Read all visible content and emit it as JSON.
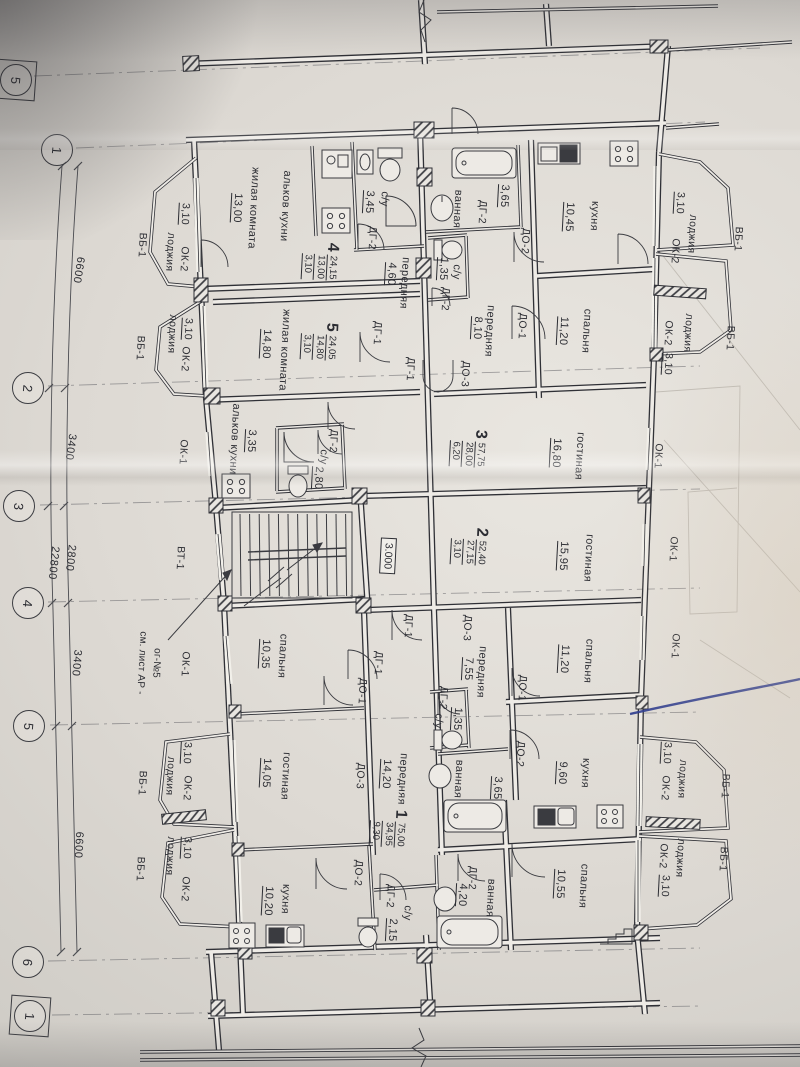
{
  "sheet": {
    "paper_color": "#dfdcd6",
    "ink_color": "#2c2d33",
    "pen_color": "#2c3b8e",
    "drawing_type": "apartment floor plan"
  },
  "axes": [
    {
      "label": "5",
      "x": 16,
      "y": 80,
      "boxed": true
    },
    {
      "label": "1",
      "x": 57,
      "y": 150,
      "boxed": false
    },
    {
      "label": "2",
      "x": 28,
      "y": 388,
      "boxed": false
    },
    {
      "label": "3",
      "x": 19,
      "y": 506,
      "boxed": false
    },
    {
      "label": "4",
      "x": 28,
      "y": 603,
      "boxed": false
    },
    {
      "label": "5",
      "x": 29,
      "y": 726,
      "boxed": false
    },
    {
      "label": "6",
      "x": 28,
      "y": 962,
      "boxed": false
    },
    {
      "label": "1",
      "x": 30,
      "y": 1016,
      "boxed": true
    }
  ],
  "dimensions": [
    {
      "text": "6600",
      "x": 78,
      "y": 270,
      "rot": 99
    },
    {
      "text": "3400",
      "x": 70,
      "y": 447,
      "rot": 98
    },
    {
      "text": "2800",
      "x": 70,
      "y": 558,
      "rot": 96
    },
    {
      "text": "22800",
      "x": 53,
      "y": 563,
      "rot": 96
    },
    {
      "text": "3400",
      "x": 76,
      "y": 663,
      "rot": 95
    },
    {
      "text": "6600",
      "x": 78,
      "y": 845,
      "rot": 93
    }
  ],
  "apartments": [
    {
      "number": "4",
      "total_area": "24,15",
      "living_area": "13,00",
      "kitchen_area": "3,10",
      "x": 320,
      "y": 261
    },
    {
      "number": "5",
      "total_area": "24,05",
      "living_area": "14,80",
      "kitchen_area": "3,10",
      "x": 319,
      "y": 341
    },
    {
      "number": "3",
      "total_area": "57,75",
      "living_area": "28,00",
      "kitchen_area": "6,20",
      "x": 468,
      "y": 448
    },
    {
      "number": "2",
      "total_area": "52,40",
      "living_area": "27,15",
      "kitchen_area": "3,10",
      "x": 469,
      "y": 546
    },
    {
      "number": "1",
      "total_area": "75,00",
      "living_area": "34,95",
      "kitchen_area": "9,30",
      "x": 388,
      "y": 828
    }
  ],
  "rooms": [
    {
      "n": "жилая комната",
      "a": "13,00",
      "nx": 253,
      "ny": 208,
      "ax": 237,
      "ay": 208
    },
    {
      "n": "альков кухни",
      "a": "",
      "nx": 285,
      "ny": 206,
      "ax": 0,
      "ay": 0
    },
    {
      "n": "с/у",
      "a": "3,45",
      "nx": 384,
      "ny": 199,
      "ax": 369,
      "ay": 202
    },
    {
      "n": "передняя",
      "a": "4,60",
      "nx": 404,
      "ny": 283,
      "ax": 391,
      "ay": 274
    },
    {
      "n": "ванная",
      "a": "3,65",
      "nx": 457,
      "ny": 209,
      "ax": 504,
      "ay": 196
    },
    {
      "n": "с/у",
      "a": "1,35",
      "nx": 456,
      "ny": 272,
      "ax": 443,
      "ay": 269
    },
    {
      "n": "кухня",
      "a": "10,45",
      "nx": 594,
      "ny": 216,
      "ax": 569,
      "ay": 217
    },
    {
      "n": "передняя",
      "a": "8,10",
      "nx": 489,
      "ny": 331,
      "ax": 477,
      "ay": 328
    },
    {
      "n": "спальня",
      "a": "11,20",
      "nx": 586,
      "ny": 331,
      "ax": 563,
      "ay": 331
    },
    {
      "n": "жилая комната",
      "a": "14,80",
      "nx": 284,
      "ny": 350,
      "ax": 266,
      "ay": 344
    },
    {
      "n": "альков кухни",
      "a": "3,35",
      "nx": 234,
      "ny": 439,
      "ax": 251,
      "ay": 441
    },
    {
      "n": "с/у",
      "a": "2,80",
      "nx": 323,
      "ny": 457,
      "ax": 318,
      "ay": 478
    },
    {
      "n": "гостиная",
      "a": "16,80",
      "nx": 579,
      "ny": 456,
      "ax": 556,
      "ay": 453
    },
    {
      "n": "гостиная",
      "a": "15,95",
      "nx": 588,
      "ny": 558,
      "ax": 563,
      "ay": 556
    },
    {
      "n": "спальня",
      "a": "10,35",
      "nx": 282,
      "ny": 656,
      "ax": 265,
      "ay": 654
    },
    {
      "n": "передняя",
      "a": "7,55",
      "nx": 481,
      "ny": 672,
      "ax": 468,
      "ay": 669
    },
    {
      "n": "спальня",
      "a": "11,20",
      "nx": 588,
      "ny": 661,
      "ax": 564,
      "ay": 659
    },
    {
      "n": "с/у",
      "a": "1,35",
      "nx": 438,
      "ny": 721,
      "ax": 457,
      "ay": 719
    },
    {
      "n": "кухня",
      "a": "9,60",
      "nx": 585,
      "ny": 773,
      "ax": 562,
      "ay": 773
    },
    {
      "n": "ванная",
      "a": "3,65",
      "nx": 458,
      "ny": 779,
      "ax": 497,
      "ay": 788
    },
    {
      "n": "передняя",
      "a": "14,20",
      "nx": 402,
      "ny": 779,
      "ax": 386,
      "ay": 774
    },
    {
      "n": "гостиная",
      "a": "14,05",
      "nx": 285,
      "ny": 776,
      "ax": 266,
      "ay": 773
    },
    {
      "n": "кухня",
      "a": "10,20",
      "nx": 285,
      "ny": 899,
      "ax": 268,
      "ay": 901
    },
    {
      "n": "спальня",
      "a": "10,55",
      "nx": 583,
      "ny": 886,
      "ax": 560,
      "ay": 884
    },
    {
      "n": "ванная",
      "a": "4,20",
      "nx": 490,
      "ny": 898,
      "ax": 462,
      "ay": 895
    },
    {
      "n": "с/у",
      "a": "2,15",
      "nx": 407,
      "ny": 913,
      "ax": 392,
      "ay": 930
    }
  ],
  "tags": [
    {
      "t": "ДГ-2",
      "x": 372,
      "y": 238
    },
    {
      "t": "ДГ-2",
      "x": 445,
      "y": 299
    },
    {
      "t": "ДГ-2",
      "x": 482,
      "y": 212
    },
    {
      "t": "ДГ-2",
      "x": 333,
      "y": 441
    },
    {
      "t": "ДГ-2",
      "x": 443,
      "y": 698
    },
    {
      "t": "ДГ-2",
      "x": 472,
      "y": 878
    },
    {
      "t": "ДГ-2",
      "x": 390,
      "y": 896
    },
    {
      "t": "ДО-2",
      "x": 525,
      "y": 241
    },
    {
      "t": "ДО-2",
      "x": 520,
      "y": 754
    },
    {
      "t": "ДО-2",
      "x": 358,
      "y": 873
    },
    {
      "t": "ДО-1",
      "x": 522,
      "y": 326
    },
    {
      "t": "ДО-1",
      "x": 362,
      "y": 691
    },
    {
      "t": "ДО-1",
      "x": 522,
      "y": 688
    },
    {
      "t": "ДГ-1",
      "x": 377,
      "y": 333
    },
    {
      "t": "ДГ-1",
      "x": 410,
      "y": 369
    },
    {
      "t": "ДГ-1",
      "x": 408,
      "y": 626
    },
    {
      "t": "ДГ-1",
      "x": 378,
      "y": 663
    },
    {
      "t": "ДО-3",
      "x": 465,
      "y": 374
    },
    {
      "t": "ДО-3",
      "x": 467,
      "y": 628
    },
    {
      "t": "ДО-3",
      "x": 360,
      "y": 776
    },
    {
      "t": "ВТ-1",
      "x": 180,
      "y": 558
    },
    {
      "t": "ОК-1",
      "x": 183,
      "y": 452
    },
    {
      "t": "ОК-1",
      "x": 185,
      "y": 664
    },
    {
      "t": "ОК-1",
      "x": 658,
      "y": 456
    },
    {
      "t": "ОК-1",
      "x": 673,
      "y": 549
    },
    {
      "t": "ОК-1",
      "x": 675,
      "y": 646
    },
    {
      "t": "3,10",
      "x": 185,
      "y": 214,
      "u": true
    },
    {
      "t": "лоджия",
      "x": 170,
      "y": 252
    },
    {
      "t": "ОК-2",
      "x": 184,
      "y": 259
    },
    {
      "t": "ВБ-1",
      "x": 142,
      "y": 245
    },
    {
      "t": "3,10",
      "x": 188,
      "y": 329,
      "u": true
    },
    {
      "t": "лоджия",
      "x": 172,
      "y": 334
    },
    {
      "t": "ОК-2",
      "x": 185,
      "y": 359
    },
    {
      "t": "ВБ-1",
      "x": 140,
      "y": 348
    },
    {
      "t": "3,10",
      "x": 680,
      "y": 203,
      "u": true
    },
    {
      "t": "лоджия",
      "x": 692,
      "y": 234
    },
    {
      "t": "ОК-2",
      "x": 675,
      "y": 251
    },
    {
      "t": "ВБ-1",
      "x": 738,
      "y": 239
    },
    {
      "t": "лоджия",
      "x": 688,
      "y": 333
    },
    {
      "t": "ОК-2",
      "x": 668,
      "y": 333
    },
    {
      "t": "3,10",
      "x": 668,
      "y": 364,
      "u": true
    },
    {
      "t": "ВБ-1",
      "x": 730,
      "y": 338
    },
    {
      "t": "3,10",
      "x": 187,
      "y": 753,
      "u": true
    },
    {
      "t": "лоджия",
      "x": 170,
      "y": 776
    },
    {
      "t": "ОК-2",
      "x": 187,
      "y": 788
    },
    {
      "t": "ВБ-1",
      "x": 142,
      "y": 783
    },
    {
      "t": "3,10",
      "x": 187,
      "y": 848,
      "u": true
    },
    {
      "t": "лоджия",
      "x": 170,
      "y": 856
    },
    {
      "t": "ОК-2",
      "x": 185,
      "y": 889
    },
    {
      "t": "ВБ-1",
      "x": 140,
      "y": 869
    },
    {
      "t": "3,10",
      "x": 667,
      "y": 753,
      "u": true
    },
    {
      "t": "лоджия",
      "x": 682,
      "y": 779
    },
    {
      "t": "ОК-2",
      "x": 665,
      "y": 788
    },
    {
      "t": "ВБ-1",
      "x": 725,
      "y": 786
    },
    {
      "t": "лоджия",
      "x": 680,
      "y": 858
    },
    {
      "t": "ОК-2",
      "x": 663,
      "y": 856
    },
    {
      "t": "3,10",
      "x": 665,
      "y": 886,
      "u": true
    },
    {
      "t": "ВБ-1",
      "x": 723,
      "y": 859
    }
  ],
  "note": {
    "line1": "ог-№5",
    "line2": "см. лист АР -",
    "x1": 156,
    "y1": 663,
    "x2": 141,
    "y2": 663
  },
  "elevation": {
    "text": "3.000",
    "x": 388,
    "y": 556
  }
}
